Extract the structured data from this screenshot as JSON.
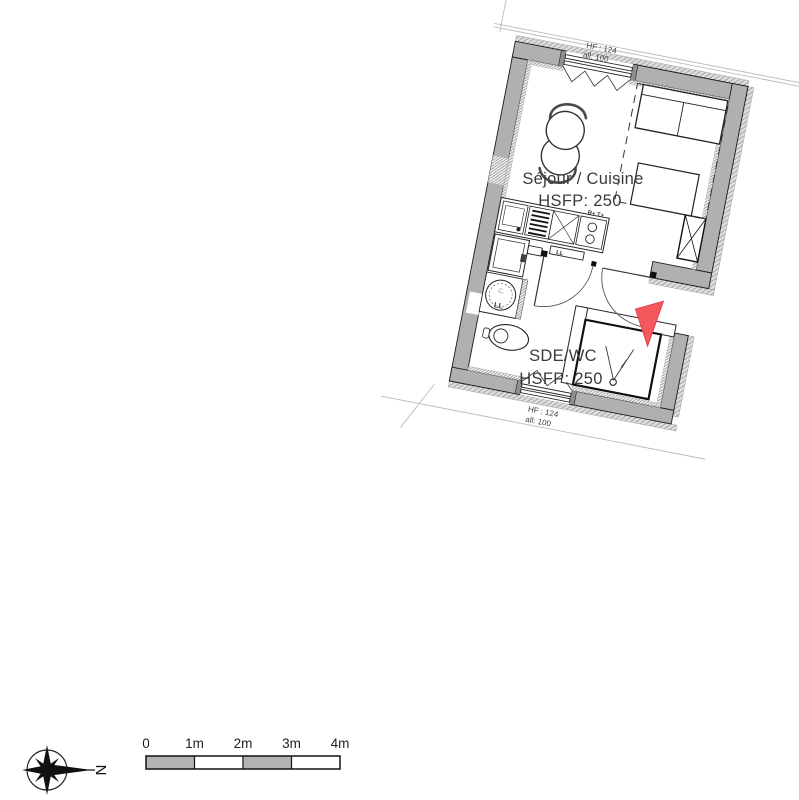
{
  "plan": {
    "living_room": {
      "name": "Séjour / Cuisine",
      "height_label": "HSFP: 250"
    },
    "bathroom": {
      "name": "SDE/WC",
      "height_label": "HSFP: 250"
    },
    "window_top": {
      "height": "HF : 124",
      "sill": "all: 100"
    },
    "window_bottom": {
      "height": "HF : 124",
      "sill": "all: 100"
    },
    "kitchen": {
      "cooktop_label": "R+ T+",
      "counter_label": "LL",
      "washer_mark": "C.",
      "washer_label": "LL"
    },
    "colors": {
      "wall_gray": "#b0b0b0",
      "entrance_arrow_red": "#f4575c",
      "annotation_blue": "#3a5ba0"
    }
  },
  "compass": {
    "north": "N"
  },
  "scale_bar": {
    "ticks": [
      "0",
      "1m",
      "2m",
      "3m",
      "4m"
    ],
    "segment_gray": "#b3b3b3"
  }
}
